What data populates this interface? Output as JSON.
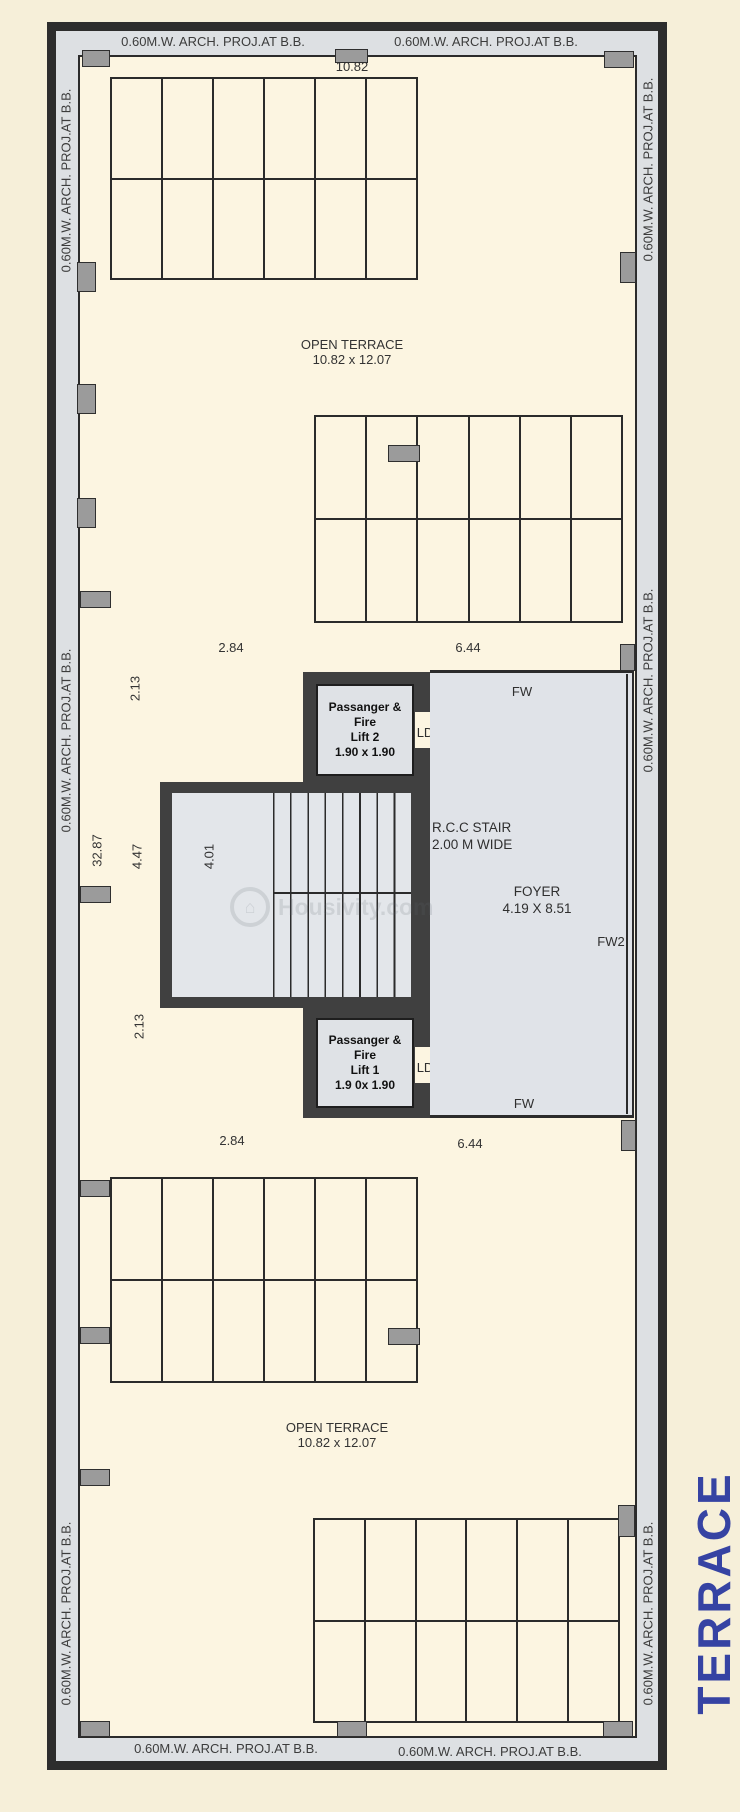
{
  "title": {
    "text": "TERRACE",
    "color": "#3643a3"
  },
  "band_label": "0.60M.W. ARCH. PROJ.AT B.B.",
  "open_terrace": {
    "name": "OPEN TERRACE",
    "size": "10.82 x 12.07"
  },
  "dimensions": {
    "top_width": "10.82",
    "left_span": "2.84",
    "right_span": "6.44",
    "lift_offset": "2.13",
    "stair_depth": "4.47",
    "total_depth": "32.87",
    "landing_width": "4.01"
  },
  "lift2": {
    "lines": [
      "Passanger &",
      "Fire",
      "Lift 2",
      "1.90 x 1.90"
    ]
  },
  "lift1": {
    "lines": [
      "Passanger &",
      "Fire",
      "Lift 1",
      "1.9 0x 1.90"
    ]
  },
  "stair": {
    "line1": "R.C.C STAIR",
    "line2": "2.00 M WIDE"
  },
  "foyer": {
    "name": "FOYER",
    "size": "4.19 X 8.51"
  },
  "labels": {
    "fw": "FW",
    "fw2": "FW2",
    "ld": "LD"
  },
  "watermark": "Housivity.com",
  "colors": {
    "wall": "#2d2d2d",
    "projection_band": "#dde0e3",
    "floor": "#fcf5e1",
    "core_fill": "#e0e3e8",
    "marker": "#9b9b9b"
  }
}
